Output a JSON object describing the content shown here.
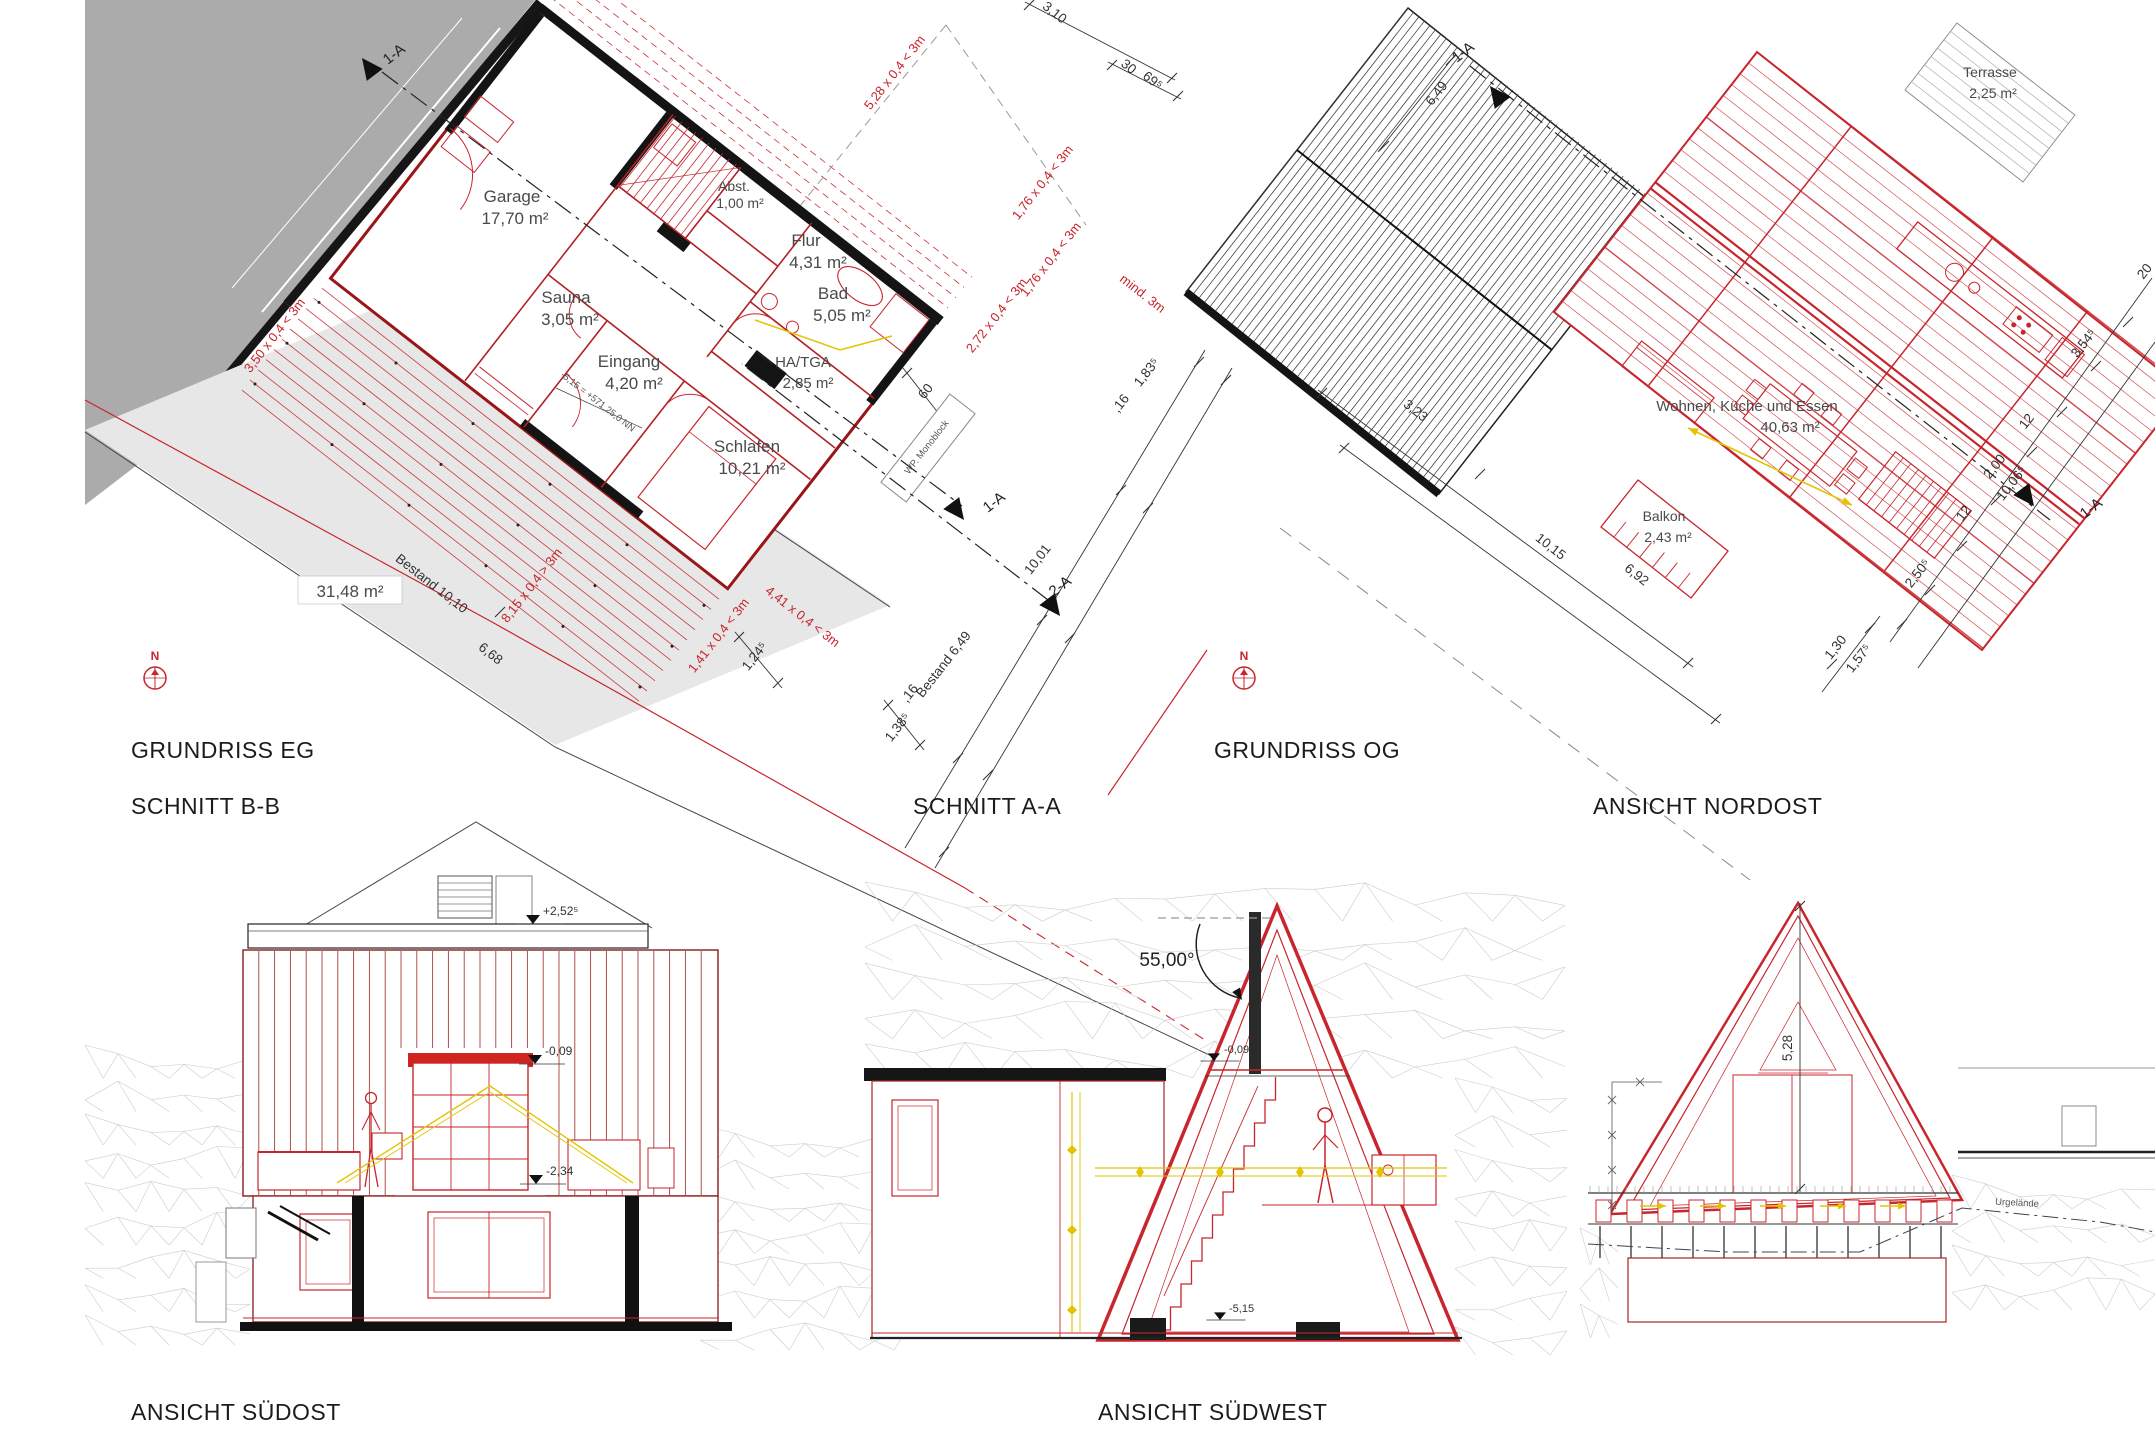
{
  "titles": {
    "grundriss_eg": "GRUNDRISS EG",
    "grundriss_og": "GRUNDRISS OG",
    "schnitt_bb": "SCHNITT B-B",
    "schnitt_aa": "SCHNITT A-A",
    "ansicht_nordost": "ANSICHT NORDOST",
    "ansicht_suedost": "ANSICHT SÜDOST",
    "ansicht_suedwest": "ANSICHT SÜDWEST"
  },
  "colors": {
    "line_red": "#c8252c",
    "wall_dark": "#141414",
    "dim_red": "#c8252c",
    "grey_fill": "#ababab",
    "light_grey_fill": "#e7e7e7",
    "mesh_grey": "#cccccc",
    "yellow": "#e3c400",
    "text_dark": "#3a3a3a"
  },
  "grundriss_eg": {
    "rooms": {
      "garage": {
        "name": "Garage",
        "area": "17,70 m²"
      },
      "sauna": {
        "name": "Sauna",
        "area": "3,05 m²"
      },
      "eingang": {
        "name": "Eingang",
        "area": "4,20 m²"
      },
      "flur": {
        "name": "Flur",
        "area": "4,31 m²"
      },
      "abst": {
        "name": "Abst.",
        "area": "1,00 m²"
      },
      "bad": {
        "name": "Bad",
        "area": "5,05 m²"
      },
      "hatga": {
        "name": "HA/TGA",
        "area": "2,85 m²"
      },
      "schlafen": {
        "name": "Schlafen",
        "area": "10,21 m²"
      }
    },
    "site": {
      "bestand_area": "31,48 m²",
      "bestand_length": "Bestand 10,10",
      "d_6_68": "6,68",
      "bestand_6_49": "Bestand 6,49"
    },
    "dims": {
      "d_3_10": "3,10",
      "d_30": "30",
      "d_69_5": "69⁵",
      "d_1_83_5": "1,83⁵",
      "d_16_a": ",16",
      "d_10_01": "10,01",
      "d_16_b": ",16",
      "d_60": "60",
      "d_1_24_5": "1,24⁵",
      "d_1_38_5": "1,38⁵"
    },
    "red_dims": {
      "d_8_15": "8,15 x 0,4 > 3m",
      "d_3_50": "3,50 x 0,4 < 3m",
      "d_5_28": "5,28 x 0,4 < 3m",
      "d_1_76_a": "1,76 x 0,4 < 3m",
      "d_1_76_b": "1,76 x 0,4 < 3m",
      "d_2_72": "2,72 x 0,4 < 3m",
      "d_mind_3m": "mind. 3m",
      "d_1_41": "1,41 x 0,4 < 3m",
      "d_4_41": "4,41 x 0,4 < 3m"
    },
    "annotations": {
      "level_nn": "-5,15 = +571,25,0 NN",
      "wp_monoblock": "WP. Monoblock",
      "marker_1a_top": "1-A",
      "marker_1a_mid": "1-A",
      "marker_2a": "2-A",
      "north": "N"
    }
  },
  "grundriss_og": {
    "rooms": {
      "terrasse": {
        "name": "Terrasse",
        "area": "2,25 m²"
      },
      "wohnen": {
        "name": "Wohnen, Küche und Essen",
        "area": "40,63 m²"
      },
      "balkon": {
        "name": "Balkon",
        "area": "2,43 m²"
      }
    },
    "dims": {
      "d_3_23": "3,23",
      "d_10_15": "10,15",
      "d_6_92": "6,92",
      "d_1_30": "1,30",
      "d_1_57_5": "1,57⁵",
      "d_2_50_5": "2,50⁵",
      "d_12_a": "12",
      "d_2_00": "2,00",
      "d_10_06_5": "10,06⁵",
      "d_12_b": "12",
      "d_3_54_5": "3,54⁵",
      "d_20": "20",
      "d_6_49": "6,49"
    },
    "annotations": {
      "marker_1a_top": "1-A",
      "marker_1a_right": "1-A",
      "north": "N"
    }
  },
  "schnitt_bb": {
    "levels": {
      "top": "+2,52⁵",
      "mid": "-0,09",
      "floor": "-2,34"
    }
  },
  "schnitt_aa": {
    "roof_angle": "55,00°",
    "levels": {
      "mid": "-0,09",
      "bottom": "-5,15"
    }
  },
  "ansicht_nordost": {
    "dim_height": "5,28",
    "terrain_label": "Urgelände"
  }
}
